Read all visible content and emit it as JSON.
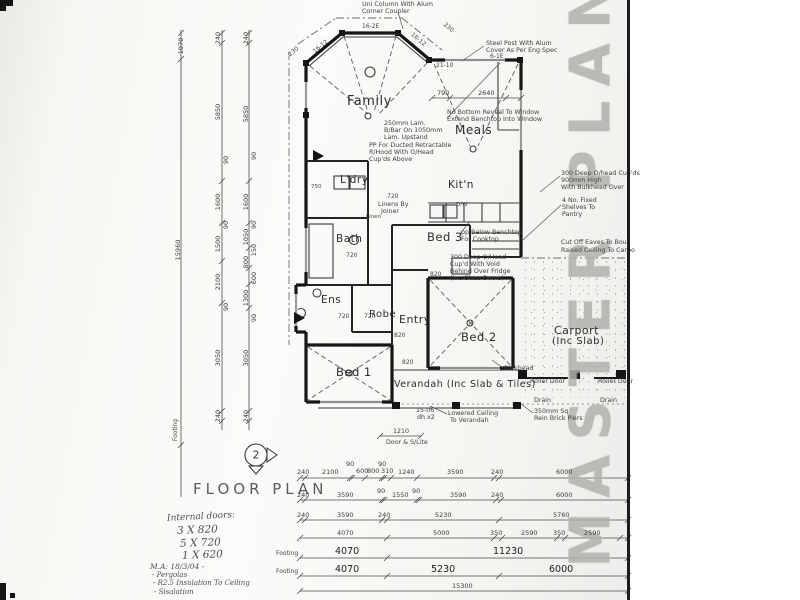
{
  "sheet": {
    "stamp": "MASTER PLAN",
    "title": "FLOOR PLAN",
    "symbol": "2"
  },
  "handwritten": {
    "doors_heading": "Internal doors:",
    "doors": [
      "3 X 820",
      "5 X 720",
      "1 X 620"
    ],
    "memo": [
      "M.A: 18/3/04 -",
      "- Pergolas",
      "- R2.5 Insulation To Ceiling",
      "- Sisalation"
    ]
  },
  "labels": [
    {
      "t": "Family",
      "x": 347,
      "y": 95,
      "c": "room",
      "s": 13,
      "n": "room-family"
    },
    {
      "t": "Meals",
      "x": 455,
      "y": 124,
      "c": "room",
      "s": 12,
      "n": "room-meals"
    },
    {
      "t": "Kit'n",
      "x": 448,
      "y": 180,
      "c": "room",
      "s": 10.5,
      "n": "room-kitchen"
    },
    {
      "t": "L'dry",
      "x": 340,
      "y": 175,
      "c": "room",
      "s": 10.5,
      "n": "room-laundry"
    },
    {
      "t": "Bath",
      "x": 336,
      "y": 234,
      "c": "room",
      "s": 10.5,
      "n": "room-bath"
    },
    {
      "t": "Bed 3",
      "x": 427,
      "y": 232,
      "c": "room",
      "s": 11.5,
      "n": "room-bed3"
    },
    {
      "t": "Ens",
      "x": 321,
      "y": 295,
      "c": "room",
      "s": 10.5,
      "n": "room-ensuite"
    },
    {
      "t": "Robe",
      "x": 369,
      "y": 310,
      "c": "room",
      "s": 10,
      "n": "room-robe"
    },
    {
      "t": "Entry",
      "x": 399,
      "y": 314,
      "c": "room",
      "s": 11,
      "n": "room-entry"
    },
    {
      "t": "Bed 1",
      "x": 336,
      "y": 367,
      "c": "room",
      "s": 11.5,
      "n": "room-bed1"
    },
    {
      "t": "Bed 2",
      "x": 461,
      "y": 332,
      "c": "room",
      "s": 11.5,
      "n": "room-bed2"
    },
    {
      "t": "Carport",
      "x": 554,
      "y": 325,
      "c": "room",
      "s": 11,
      "n": "room-carport"
    },
    {
      "t": "(Inc Slab)",
      "x": 552,
      "y": 337,
      "c": "room",
      "s": 10,
      "n": "room-carport-sub"
    },
    {
      "t": "Verandah (Inc Slab & Tiles)",
      "x": 394,
      "y": 380,
      "c": "room",
      "s": 9.5,
      "n": "room-verandah"
    },
    {
      "t": "Uni Column With Alum",
      "x": 362,
      "y": 2,
      "c": "note"
    },
    {
      "t": "Corner Coupler",
      "x": 362,
      "y": 9,
      "c": "note"
    },
    {
      "t": "Steel Post With Alum",
      "x": 486,
      "y": 41,
      "c": "note"
    },
    {
      "t": "Cover As Per Eng Spec",
      "x": 486,
      "y": 48,
      "c": "note"
    },
    {
      "t": "No Bottom Reveal To Window",
      "x": 447,
      "y": 110,
      "c": "note"
    },
    {
      "t": "Extend Benchtop Into Window",
      "x": 447,
      "y": 117,
      "c": "note"
    },
    {
      "t": "250mm Lam.",
      "x": 384,
      "y": 121,
      "c": "note"
    },
    {
      "t": "B/Bar On 1050mm",
      "x": 384,
      "y": 128,
      "c": "note"
    },
    {
      "t": "Lam. Upstand",
      "x": 384,
      "y": 135,
      "c": "note"
    },
    {
      "t": "PP For Ducted Retractable",
      "x": 369,
      "y": 143,
      "c": "note"
    },
    {
      "t": "R/Hood With O/Head",
      "x": 369,
      "y": 150,
      "c": "note"
    },
    {
      "t": "Cup'ds Above",
      "x": 369,
      "y": 157,
      "c": "note"
    },
    {
      "t": "300 Deep O/head Cup'ds",
      "x": 561,
      "y": 171,
      "c": "note"
    },
    {
      "t": "900mm High",
      "x": 561,
      "y": 178,
      "c": "note"
    },
    {
      "t": "With Bulkhead Over",
      "x": 561,
      "y": 185,
      "c": "note"
    },
    {
      "t": "4 No. Fixed",
      "x": 562,
      "y": 198,
      "c": "note"
    },
    {
      "t": "Shelves To",
      "x": 562,
      "y": 205,
      "c": "note"
    },
    {
      "t": "Pantry",
      "x": 562,
      "y": 212,
      "c": "note"
    },
    {
      "t": "Cut Off Eaves To Boun",
      "x": 561,
      "y": 240,
      "c": "note"
    },
    {
      "t": "Raised Ceiling To Carpo",
      "x": 561,
      "y": 248,
      "c": "note"
    },
    {
      "t": "pp Below Benchtop",
      "x": 461,
      "y": 230,
      "c": "note"
    },
    {
      "t": "For Cooktop",
      "x": 461,
      "y": 237,
      "c": "note"
    },
    {
      "t": "300 Deep O/Head",
      "x": 450,
      "y": 255,
      "c": "note"
    },
    {
      "t": "Cup'd With Void",
      "x": 450,
      "y": 262,
      "c": "note"
    },
    {
      "t": "Behind Over Fridge",
      "x": 450,
      "y": 269,
      "c": "note"
    },
    {
      "t": "(Inc Glass Doors)",
      "x": 450,
      "y": 276,
      "c": "note"
    },
    {
      "t": "Linens By",
      "x": 378,
      "y": 202,
      "c": "note"
    },
    {
      "t": "Joiner",
      "x": 381,
      "y": 209,
      "c": "note"
    },
    {
      "t": "Bulkhead",
      "x": 504,
      "y": 366,
      "c": "note"
    },
    {
      "t": "Roller Door",
      "x": 530,
      "y": 379,
      "c": "note"
    },
    {
      "t": "Roller Door",
      "x": 598,
      "y": 379,
      "c": "note"
    },
    {
      "t": "Drain",
      "x": 534,
      "y": 398,
      "c": "note"
    },
    {
      "t": "Drain",
      "x": 600,
      "y": 398,
      "c": "note"
    },
    {
      "t": "Lowered Ceiling",
      "x": 448,
      "y": 411,
      "c": "note"
    },
    {
      "t": "To Verandah",
      "x": 450,
      "y": 418,
      "c": "note"
    },
    {
      "t": "350mm Sq",
      "x": 534,
      "y": 409,
      "c": "note"
    },
    {
      "t": "Rein Brick Piers",
      "x": 534,
      "y": 416,
      "c": "note"
    },
    {
      "t": "15-06",
      "x": 416,
      "y": 408,
      "c": "note"
    },
    {
      "t": "dh x2",
      "x": 417,
      "y": 415,
      "c": "note"
    },
    {
      "t": "1210",
      "x": 393,
      "y": 429,
      "c": "note"
    },
    {
      "t": "Door & S/Lite",
      "x": 386,
      "y": 440,
      "c": "note"
    },
    {
      "t": "Linen",
      "x": 366,
      "y": 215,
      "c": "tag",
      "s": 5.5
    },
    {
      "t": "D/W",
      "x": 456,
      "y": 203,
      "c": "tag",
      "s": 5.5
    },
    {
      "t": "750",
      "x": 311,
      "y": 185,
      "c": "tag",
      "s": 5.5
    },
    {
      "t": "21-10",
      "x": 436,
      "y": 63,
      "c": "tag"
    },
    {
      "t": "6-1E",
      "x": 490,
      "y": 54,
      "c": "tag"
    },
    {
      "t": "16-2E",
      "x": 362,
      "y": 24,
      "c": "tag"
    },
    {
      "t": "16-12",
      "x": 321,
      "y": 47,
      "c": "tag",
      "r": -40
    },
    {
      "t": "16-12",
      "x": 418,
      "y": 40,
      "c": "tag",
      "r": 40
    },
    {
      "t": "230",
      "x": 294,
      "y": 52,
      "c": "tag",
      "r": -40
    },
    {
      "t": "230",
      "x": 448,
      "y": 28,
      "c": "tag",
      "r": 40
    },
    {
      "t": "720",
      "x": 387,
      "y": 194,
      "c": "tag"
    },
    {
      "t": "720",
      "x": 346,
      "y": 253,
      "c": "tag"
    },
    {
      "t": "720",
      "x": 338,
      "y": 314,
      "c": "tag"
    },
    {
      "t": "720",
      "x": 364,
      "y": 314,
      "c": "tag"
    },
    {
      "t": "820",
      "x": 394,
      "y": 333,
      "c": "tag"
    },
    {
      "t": "820",
      "x": 402,
      "y": 360,
      "c": "tag"
    },
    {
      "t": "820",
      "x": 430,
      "y": 272,
      "c": "tag"
    },
    {
      "t": "790",
      "x": 437,
      "y": 90,
      "c": "dim"
    },
    {
      "t": "2640",
      "x": 478,
      "y": 90,
      "c": "dim"
    },
    {
      "t": "1070",
      "x": 181,
      "y": 46,
      "c": "dim",
      "r": -90
    },
    {
      "t": "15960",
      "x": 178,
      "y": 250,
      "c": "dim",
      "r": -90
    },
    {
      "t": "Footing",
      "x": 176,
      "y": 430,
      "c": "tag",
      "r": -90
    },
    {
      "t": "240",
      "x": 218,
      "y": 38,
      "c": "dim",
      "r": -90
    },
    {
      "t": "5850",
      "x": 218,
      "y": 112,
      "c": "dim",
      "r": -90
    },
    {
      "t": "90",
      "x": 226,
      "y": 160,
      "c": "dim",
      "r": -90
    },
    {
      "t": "1600",
      "x": 218,
      "y": 202,
      "c": "dim",
      "r": -90
    },
    {
      "t": "90",
      "x": 226,
      "y": 225,
      "c": "dim",
      "r": -90
    },
    {
      "t": "1500",
      "x": 218,
      "y": 244,
      "c": "dim",
      "r": -90
    },
    {
      "t": "2100",
      "x": 218,
      "y": 282,
      "c": "dim",
      "r": -90
    },
    {
      "t": "90",
      "x": 226,
      "y": 307,
      "c": "dim",
      "r": -90
    },
    {
      "t": "3050",
      "x": 218,
      "y": 358,
      "c": "dim",
      "r": -90
    },
    {
      "t": "240",
      "x": 218,
      "y": 416,
      "c": "dim",
      "r": -90
    },
    {
      "t": "240",
      "x": 246,
      "y": 38,
      "c": "dim",
      "r": -90
    },
    {
      "t": "5850",
      "x": 246,
      "y": 114,
      "c": "dim",
      "r": -90
    },
    {
      "t": "90",
      "x": 254,
      "y": 156,
      "c": "dim",
      "r": -90
    },
    {
      "t": "1600",
      "x": 246,
      "y": 202,
      "c": "dim",
      "r": -90
    },
    {
      "t": "90",
      "x": 254,
      "y": 225,
      "c": "dim",
      "r": -90
    },
    {
      "t": "1050",
      "x": 246,
      "y": 237,
      "c": "dim",
      "r": -90
    },
    {
      "t": "150",
      "x": 254,
      "y": 250,
      "c": "dim",
      "r": -90
    },
    {
      "t": "800",
      "x": 246,
      "y": 262,
      "c": "dim",
      "r": -90
    },
    {
      "t": "600",
      "x": 254,
      "y": 278,
      "c": "dim",
      "r": -90
    },
    {
      "t": "1300",
      "x": 246,
      "y": 298,
      "c": "dim",
      "r": -90
    },
    {
      "t": "90",
      "x": 254,
      "y": 318,
      "c": "dim",
      "r": -90
    },
    {
      "t": "3050",
      "x": 246,
      "y": 358,
      "c": "dim",
      "r": -90
    },
    {
      "t": "240",
      "x": 246,
      "y": 416,
      "c": "dim",
      "r": -90
    },
    {
      "t": "90",
      "x": 346,
      "y": 461,
      "c": "dim"
    },
    {
      "t": "90",
      "x": 378,
      "y": 461,
      "c": "dim"
    },
    {
      "t": "600",
      "x": 356,
      "y": 468,
      "c": "dim"
    },
    {
      "t": "800",
      "x": 367,
      "y": 468,
      "c": "dim"
    },
    {
      "t": "310",
      "x": 381,
      "y": 468,
      "c": "dim"
    },
    {
      "t": "240",
      "x": 297,
      "y": 469,
      "c": "dim"
    },
    {
      "t": "2100",
      "x": 322,
      "y": 469,
      "c": "dim"
    },
    {
      "t": "1240",
      "x": 398,
      "y": 469,
      "c": "dim"
    },
    {
      "t": "3590",
      "x": 447,
      "y": 469,
      "c": "dim"
    },
    {
      "t": "240",
      "x": 491,
      "y": 469,
      "c": "dim"
    },
    {
      "t": "6000",
      "x": 556,
      "y": 469,
      "c": "dim"
    },
    {
      "t": "240",
      "x": 297,
      "y": 492,
      "c": "dim"
    },
    {
      "t": "3590",
      "x": 337,
      "y": 492,
      "c": "dim"
    },
    {
      "t": "90",
      "x": 377,
      "y": 488,
      "c": "dim"
    },
    {
      "t": "1550",
      "x": 392,
      "y": 492,
      "c": "dim"
    },
    {
      "t": "90",
      "x": 412,
      "y": 488,
      "c": "dim"
    },
    {
      "t": "3590",
      "x": 450,
      "y": 492,
      "c": "dim"
    },
    {
      "t": "240",
      "x": 491,
      "y": 492,
      "c": "dim"
    },
    {
      "t": "6000",
      "x": 556,
      "y": 492,
      "c": "dim"
    },
    {
      "t": "240",
      "x": 297,
      "y": 512,
      "c": "dim"
    },
    {
      "t": "3590",
      "x": 337,
      "y": 512,
      "c": "dim"
    },
    {
      "t": "240",
      "x": 378,
      "y": 512,
      "c": "dim"
    },
    {
      "t": "5230",
      "x": 435,
      "y": 512,
      "c": "dim"
    },
    {
      "t": "5760",
      "x": 553,
      "y": 512,
      "c": "dim"
    },
    {
      "t": "4070",
      "x": 337,
      "y": 530,
      "c": "dim"
    },
    {
      "t": "5000",
      "x": 433,
      "y": 530,
      "c": "dim"
    },
    {
      "t": "350",
      "x": 490,
      "y": 530,
      "c": "dim"
    },
    {
      "t": "2590",
      "x": 521,
      "y": 530,
      "c": "dim"
    },
    {
      "t": "350",
      "x": 553,
      "y": 530,
      "c": "dim"
    },
    {
      "t": "2590",
      "x": 584,
      "y": 530,
      "c": "dim"
    },
    {
      "t": "Footing",
      "x": 276,
      "y": 551,
      "c": "tag"
    },
    {
      "t": "4070",
      "x": 335,
      "y": 547,
      "c": "dimbig"
    },
    {
      "t": "11230",
      "x": 493,
      "y": 547,
      "c": "dimbig"
    },
    {
      "t": "Footing",
      "x": 276,
      "y": 569,
      "c": "tag"
    },
    {
      "t": "4070",
      "x": 335,
      "y": 565,
      "c": "dimbig"
    },
    {
      "t": "5230",
      "x": 431,
      "y": 565,
      "c": "dimbig"
    },
    {
      "t": "6000",
      "x": 549,
      "y": 565,
      "c": "dimbig"
    },
    {
      "t": "15300",
      "x": 452,
      "y": 583,
      "c": "dim"
    }
  ]
}
